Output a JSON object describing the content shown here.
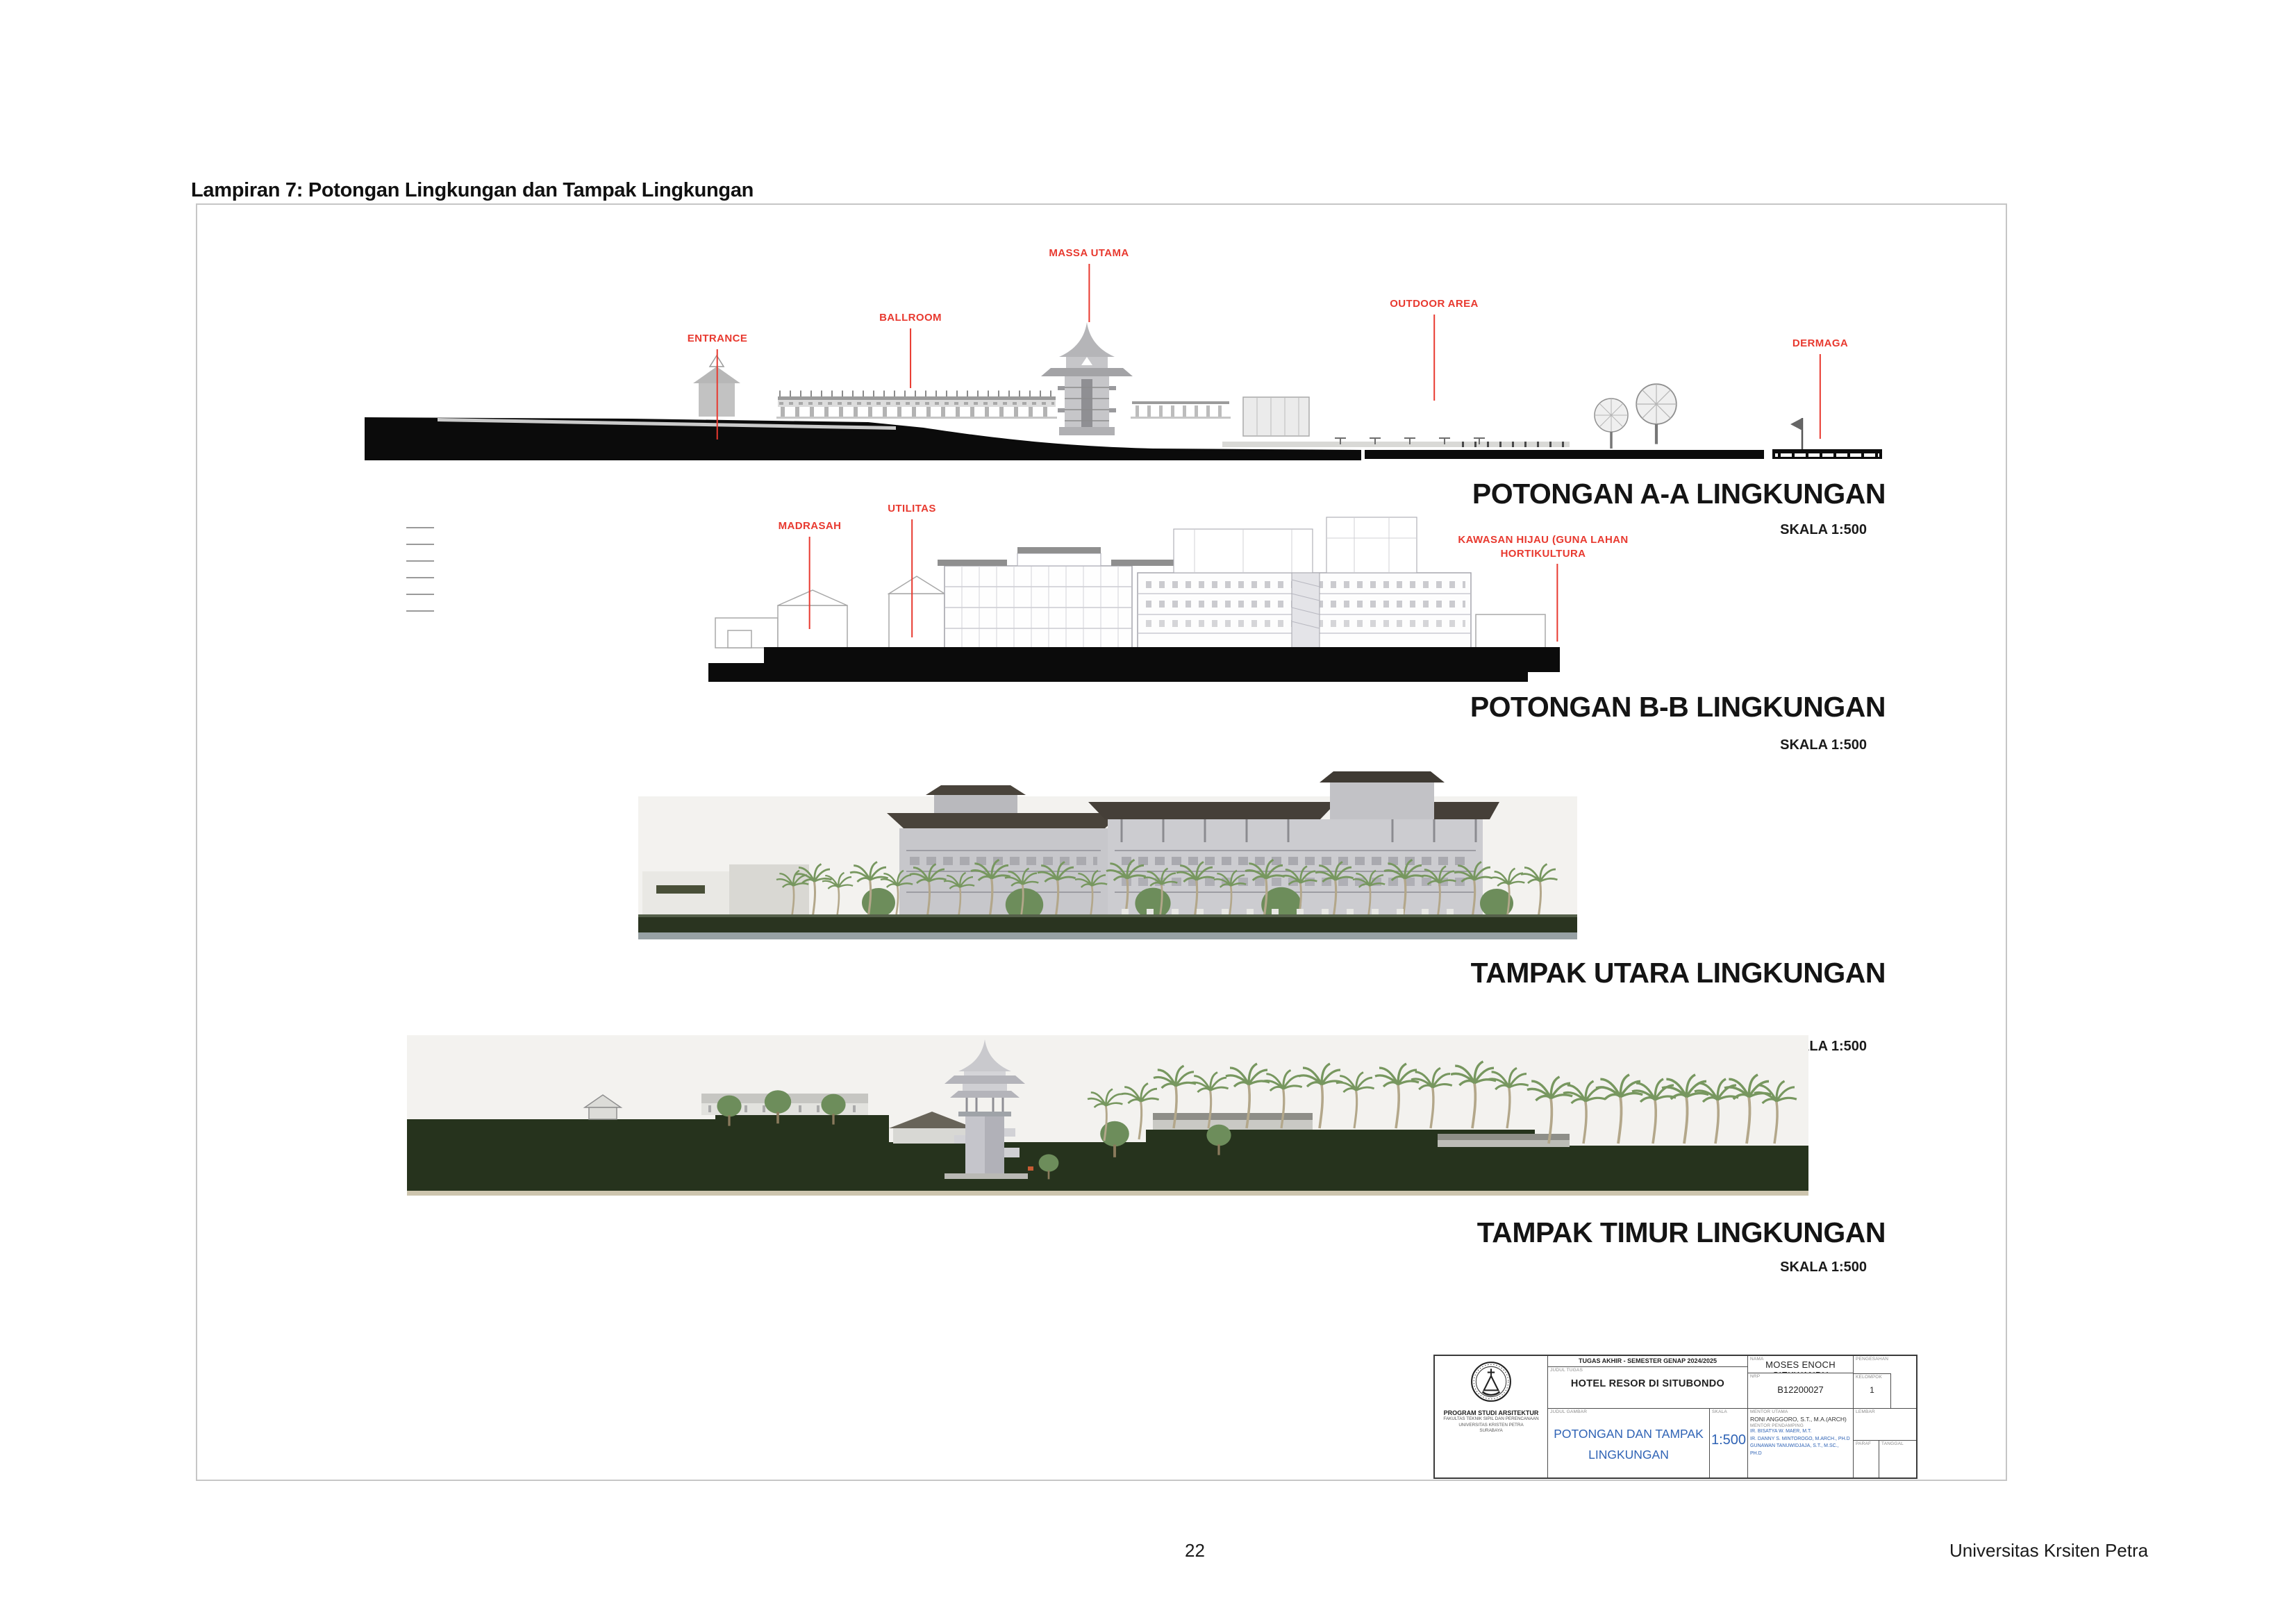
{
  "page": {
    "heading": "Lampiran 7: Potongan Lingkungan dan Tampak Lingkungan",
    "page_number": "22",
    "footer_right": "Universitas Krsiten Petra"
  },
  "sheet": {
    "drawings": [
      {
        "id": "potongan-aa",
        "title": "POTONGAN A-A LINGKUNGAN",
        "scale": "SKALA 1:500",
        "labels": [
          {
            "text": "ENTRANCE"
          },
          {
            "text": "BALLROOM"
          },
          {
            "text": "MASSA UTAMA"
          },
          {
            "text": "OUTDOOR AREA"
          },
          {
            "text": "DERMAGA"
          }
        ]
      },
      {
        "id": "potongan-bb",
        "title": "POTONGAN B-B LINGKUNGAN",
        "scale": "SKALA 1:500",
        "labels": [
          {
            "text": "MADRASAH"
          },
          {
            "text": "UTILITAS"
          },
          {
            "text": "KAWASAN HIJAU (GUNA LAHAN"
          },
          {
            "text": "HORTIKULTURA"
          }
        ]
      },
      {
        "id": "tampak-utara",
        "title": "TAMPAK UTARA LINGKUNGAN",
        "scale": "SKALA 1:500",
        "labels": []
      },
      {
        "id": "tampak-timur",
        "title": "TAMPAK TIMUR LINGKUNGAN",
        "scale": "SKALA 1:500",
        "labels": []
      }
    ],
    "title_block": {
      "course": "TUGAS AKHIR - SEMESTER GENAP 2024/2025",
      "labels": {
        "judul_tugas": "JUDUL TUGAS",
        "judul_gambar": "JUDUL GAMBAR",
        "skala": "SKALA",
        "nama": "NAMA",
        "nrp": "NRP",
        "kelompok": "KELOMPOK",
        "pengesahan": "PENGESAHAN",
        "mentor_utama": "MENTOR UTAMA",
        "mentor_pendamping": "MENTOR PENDAMPING",
        "lembar": "LEMBAR",
        "paraf": "PARAF",
        "tanggal": "TANGGAL"
      },
      "project_title": "HOTEL RESOR DI SITUBONDO",
      "drawing_title_line1": "POTONGAN DAN TAMPAK",
      "drawing_title_line2": "LINGKUNGAN",
      "scale_value": "1:500",
      "student_name": "MOSES ENOCH SIEKWANDY",
      "student_id": "B12200027",
      "group_number": "1",
      "mentor_utama_name": "RONI ANGGORO, S.T., M.A.(ARCH)",
      "mentors": [
        "IR. BISATYA W. MAER, M.T.",
        "IR. DANNY S. MINTOROGO, M.ARCH., PH.D",
        "GUNAWAN TANUWIDJAJA, S.T., M.SC., PH.D"
      ],
      "program_lines": [
        "PROGRAM STUDI ARSITEKTUR",
        "FAKULTAS TEKNIK SIPIL DAN PERENCANAAN",
        "UNIVERSITAS KRISTEN PETRA",
        "SURABAYA"
      ]
    },
    "colors": {
      "label_red": "#e8392f",
      "title_blue": "#2f63b5",
      "ground_green": "#26331d",
      "roof_dark": "#453f38",
      "palm_green": "#77975f",
      "water_gray": "#97a1a4",
      "ground_black": "#0b0b0b"
    }
  }
}
